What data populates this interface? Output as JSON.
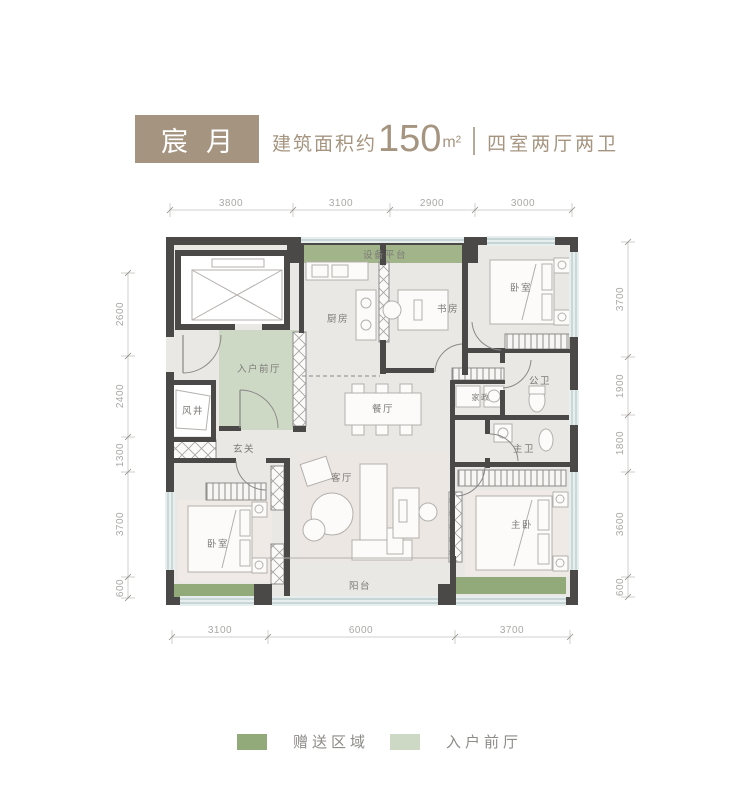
{
  "header": {
    "name": "宸月",
    "area_prefix": "建筑面积约",
    "area_value": "150",
    "area_unit": "m²",
    "layout": "四室两厅两卫"
  },
  "rooms": {
    "equipment_platform": "设备平台",
    "kitchen": "厨房",
    "study": "书房",
    "bedroom_top": "卧室",
    "entry_foyer": "入户前厅",
    "wind_shaft": "风井",
    "dining": "餐厅",
    "public_bath": "公卫",
    "housekeeping": "家政",
    "hallway": "玄关",
    "master_bath": "主卫",
    "living": "客厅",
    "bedroom_left": "卧室",
    "master_bedroom": "主卧",
    "balcony": "阳台"
  },
  "dims": {
    "top": [
      "3800",
      "3100",
      "2900",
      "3000"
    ],
    "bottom": [
      "3100",
      "6000",
      "3700"
    ],
    "left": [
      "2600",
      "2400",
      "1300",
      "3700",
      "600"
    ],
    "right": [
      "3700",
      "1900",
      "1800",
      "3600",
      "600"
    ]
  },
  "legend": {
    "gift": {
      "label": "赠送区域",
      "color": "#92aa7a",
      "style": "background:#92aa7a"
    },
    "foyer": {
      "label": "入户前厅",
      "color": "#cdd9c5",
      "style": "background:#cdd9c5"
    }
  },
  "colors": {
    "header_accent": "#a59580",
    "wall": "#4a4947",
    "floor": "#e9e8e5",
    "green_dark": "#92aa7a",
    "green_equipment": "#a2b489",
    "green_light": "#cdd9c5",
    "window": "#e7eeee"
  }
}
